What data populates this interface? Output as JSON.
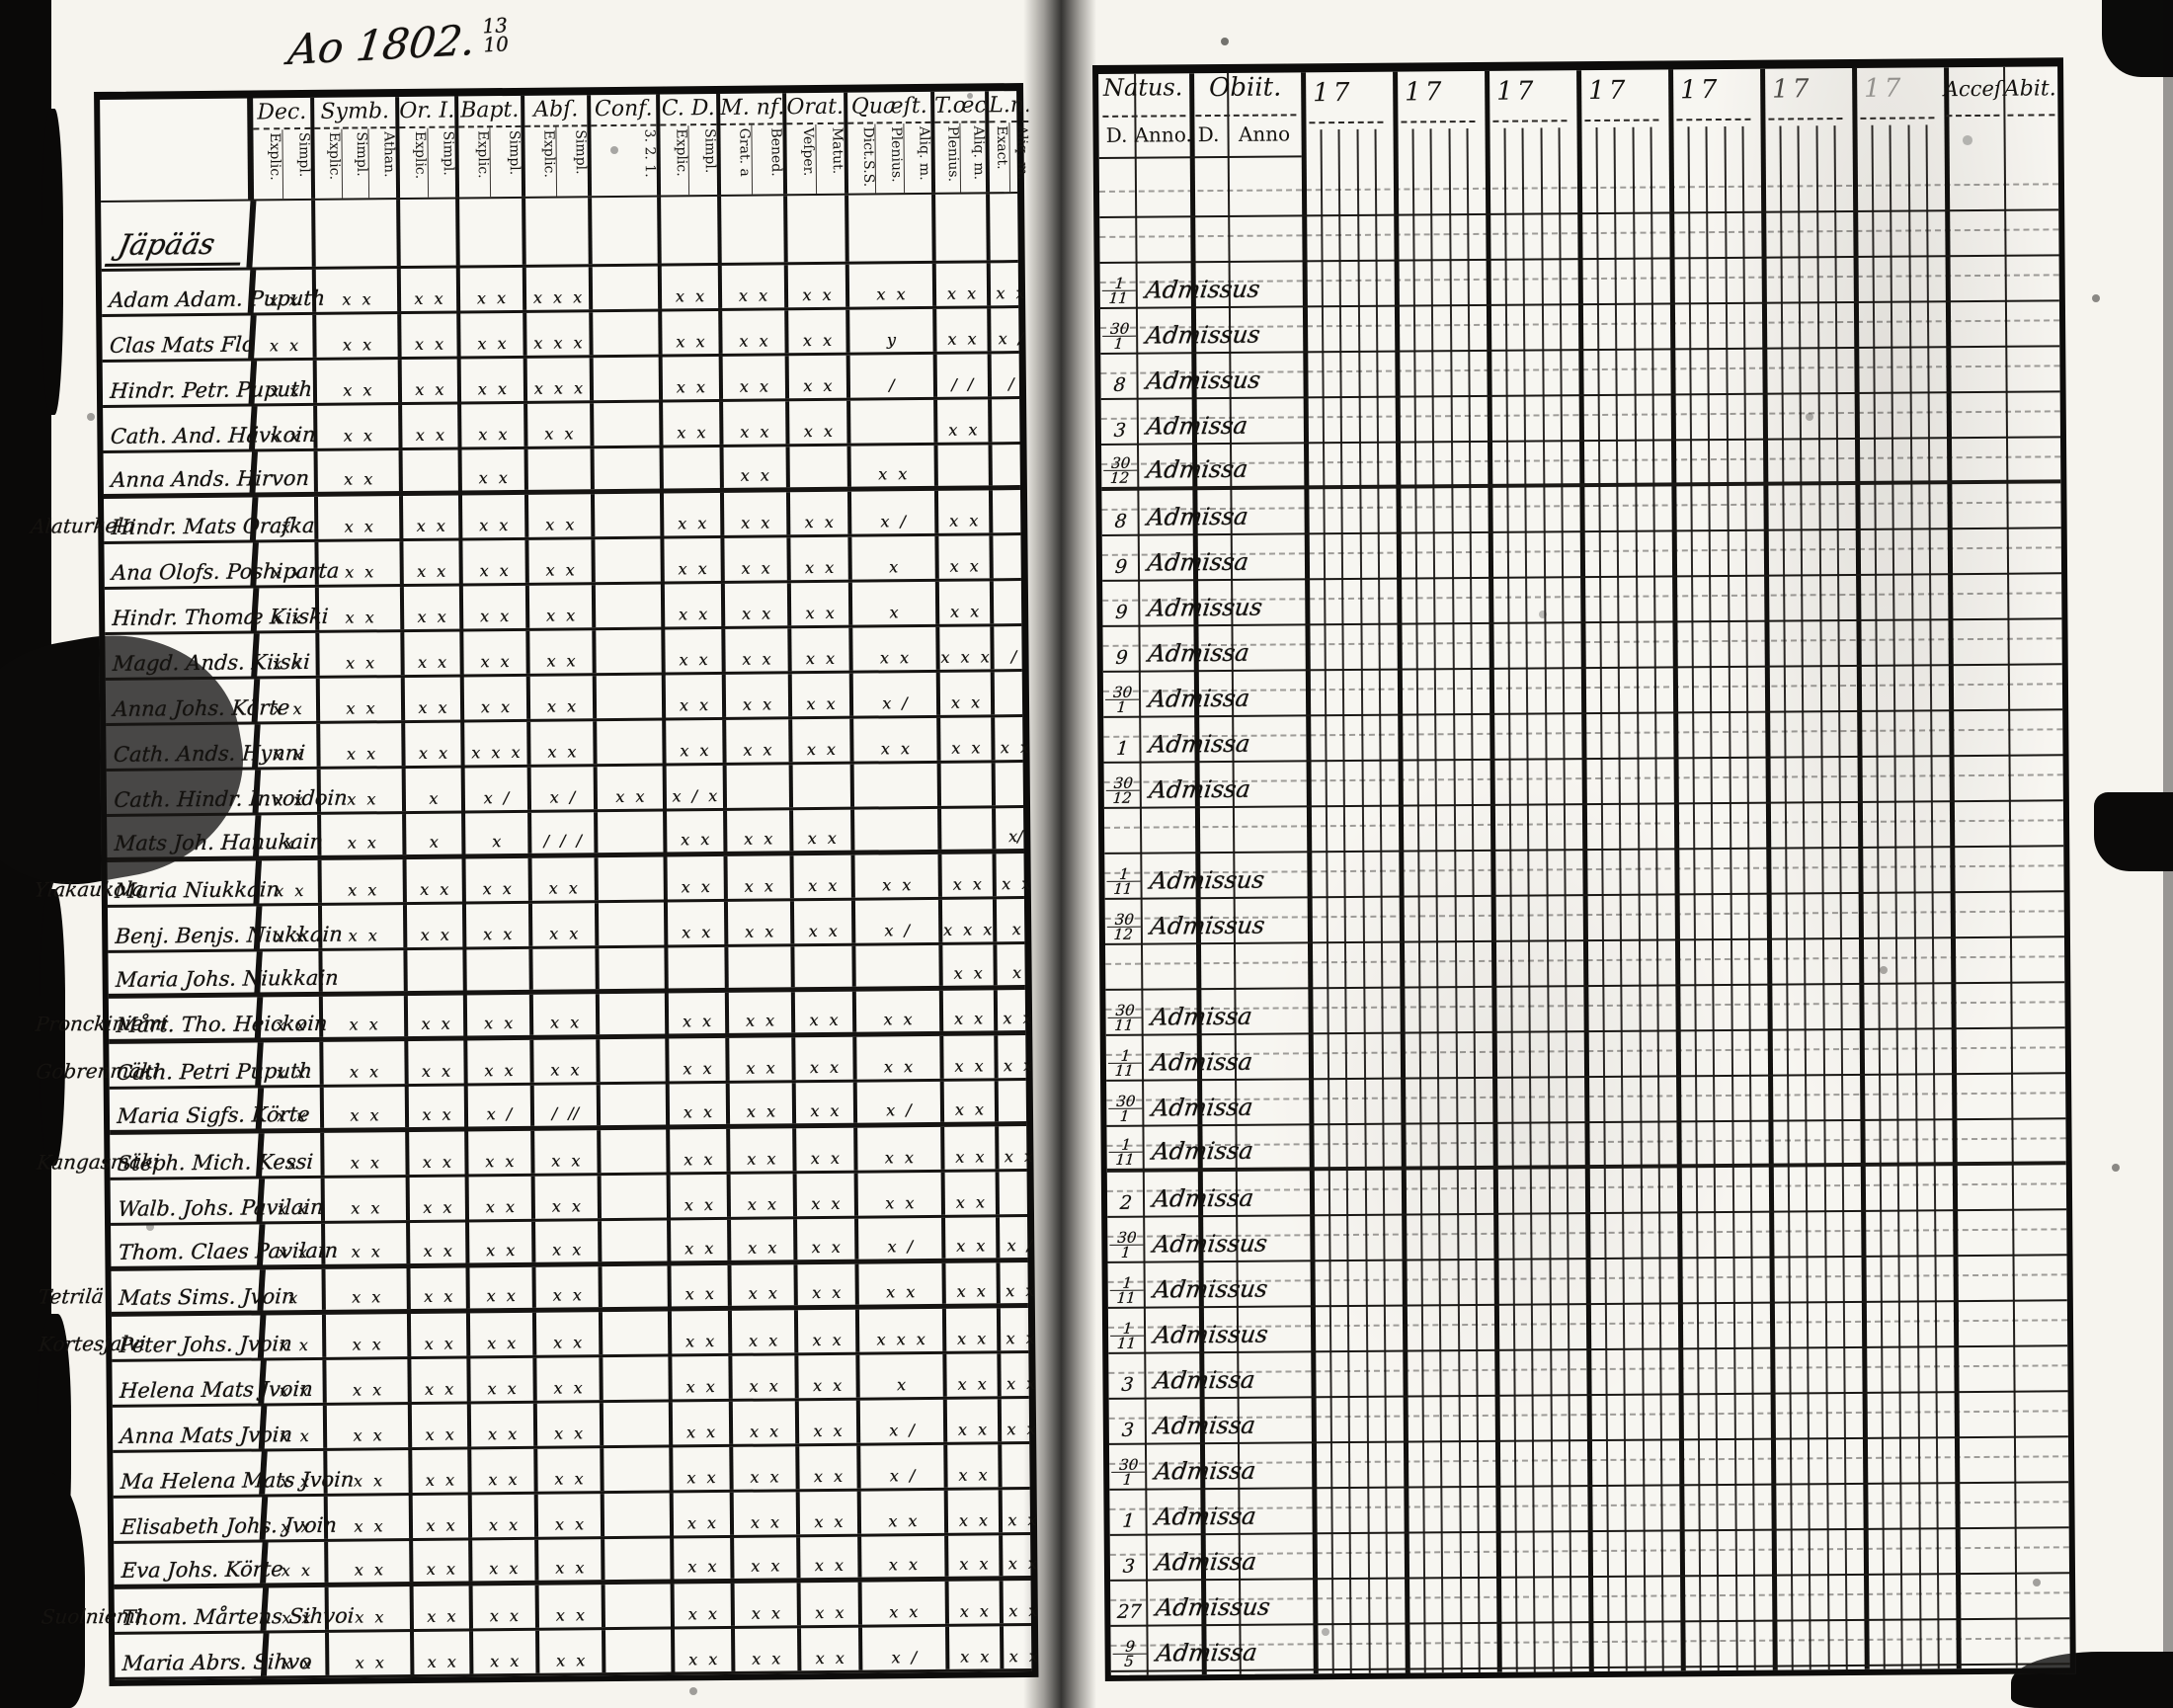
{
  "colors": {
    "ink": "#14120f",
    "paper": "#f6f4ee",
    "edge": "#0a0908"
  },
  "page": {
    "title_script": "Ao 1802.",
    "title_fraction_top": "13",
    "title_fraction_bottom": "10"
  },
  "left_table": {
    "section_header": "Jäpääs",
    "columns": [
      {
        "label": "Dec.",
        "subs": [
          "Explic.",
          "Simpl."
        ]
      },
      {
        "label": "Symb.",
        "subs": [
          "Explic.",
          "Simpl.",
          "Athan."
        ]
      },
      {
        "label": "Or. I.",
        "subs": [
          "Explic.",
          "Simpl."
        ]
      },
      {
        "label": "Bapt.",
        "subs": [
          "Explic.",
          "Simpl."
        ]
      },
      {
        "label": "Abſ.",
        "subs": [
          "Explic.",
          "Simpl."
        ]
      },
      {
        "label": "Conf.",
        "subs": [
          "3. 2. 1."
        ]
      },
      {
        "label": "C. D.",
        "subs": [
          "Explic.",
          "Simpl."
        ]
      },
      {
        "label": "M. nf.",
        "subs": [
          "Grat. a",
          "Bened."
        ]
      },
      {
        "label": "Orat.",
        "subs": [
          "Veſper.",
          "Matut."
        ]
      },
      {
        "label": "Quæſt.",
        "subs": [
          "Dict.S.S.",
          "Plenius.",
          "Aliq. m."
        ]
      },
      {
        "label": "T.œc.",
        "subs": [
          "Plenius.",
          "Aliq. m."
        ]
      },
      {
        "label": "L.n.",
        "subs": [
          "Exact.",
          "Aliq. m."
        ]
      }
    ],
    "rows": [
      {
        "margin": "",
        "name": "Adam Adam. Puputh",
        "cells": [
          "x x",
          "x x",
          "x x",
          "x x",
          "x x x",
          "",
          "x x",
          "x x",
          "x x",
          "x x",
          "x x",
          "x x"
        ]
      },
      {
        "margin": "",
        "name": "Clas Mats Flo",
        "cells": [
          "x x",
          "x x",
          "x x",
          "x x",
          "x x x",
          "",
          "x x",
          "x x",
          "x x",
          "y",
          "x x",
          "x /"
        ]
      },
      {
        "margin": "",
        "name": "Hindr. Petr. Puputh",
        "cells": [
          "x x",
          "x x",
          "x x",
          "x x",
          "x x x",
          "",
          "x x",
          "x x",
          "x x",
          "/",
          "/ /",
          "/"
        ]
      },
      {
        "margin": "",
        "name": "Cath. And. Hävkoin",
        "cells": [
          "x x",
          "x x",
          "x x",
          "x x",
          "x x",
          "",
          "x x",
          "x x",
          "x x",
          "",
          "x x",
          ""
        ]
      },
      {
        "margin": "",
        "name": "Anna Ands. Hirvon",
        "cells": [
          "",
          "x x",
          "",
          "x x",
          "",
          "",
          "",
          "x x",
          "",
          "x x",
          "",
          ""
        ]
      },
      {
        "margin": "Alaturkela",
        "name": "Hindr. Mats Orafka",
        "cells": [
          "x",
          "x x",
          "x x",
          "x x",
          "x x",
          "",
          "x x",
          "x x",
          "x x",
          "x /",
          "x x",
          ""
        ]
      },
      {
        "margin": "",
        "name": "Ana Olofs. Poshiparta",
        "cells": [
          "x x",
          "x x",
          "x x",
          "x x",
          "x x",
          "",
          "x x",
          "x x",
          "x x",
          "x",
          "x x",
          ""
        ]
      },
      {
        "margin": "",
        "name": "Hindr. Thomæ Kiiski",
        "cells": [
          "x x",
          "x x",
          "x x",
          "x x",
          "x x",
          "",
          "x x",
          "x x",
          "x x",
          "x",
          "x x",
          ""
        ]
      },
      {
        "margin": "",
        "name": "Magd. Ands. Kiiski",
        "cells": [
          "x x",
          "x x",
          "x x",
          "x x",
          "x x",
          "",
          "x x",
          "x x",
          "x x",
          "x x",
          "x x x",
          "/"
        ]
      },
      {
        "margin": "",
        "name": "Anna Johs. Körte",
        "cells": [
          "x x",
          "x x",
          "x x",
          "x x",
          "x x",
          "",
          "x x",
          "x x",
          "x x",
          "x /",
          "x x",
          ""
        ]
      },
      {
        "margin": "",
        "name": "Cath. Ands. Hynni",
        "cells": [
          "x x",
          "x x",
          "x x",
          "x x x",
          "x x",
          "",
          "x x",
          "x x",
          "x x",
          "x x",
          "x x",
          "x x"
        ]
      },
      {
        "margin": "",
        "name": "Cath. Hindr. Invoidoin",
        "cells": [
          "x x",
          "x x",
          "x",
          "x /",
          "x /",
          "x x",
          "x / x",
          "",
          "",
          "",
          "",
          ""
        ]
      },
      {
        "margin": "",
        "name": "Mats Joh. Hanukain",
        "cells": [
          "x",
          "x x",
          "x",
          "x",
          "/ / /",
          "",
          "x x",
          "x x",
          "x x",
          "",
          "",
          "x/"
        ]
      },
      {
        "margin": "Yläkaukola",
        "name": "Maria Niukkain",
        "cells": [
          "x x",
          "x x",
          "x x",
          "x x",
          "x x",
          "",
          "x x",
          "x x",
          "x x",
          "x x",
          "x x",
          "x x"
        ]
      },
      {
        "margin": "",
        "name": "Benj. Benjs. Niukkain",
        "cells": [
          "x x",
          "x x",
          "x x",
          "x x",
          "x x",
          "",
          "x x",
          "x x",
          "x x",
          "x /",
          "x x x",
          "x"
        ]
      },
      {
        "margin": "",
        "name": "Maria Johs. Niukkain",
        "cells": [
          "",
          "",
          "",
          "",
          "",
          "",
          "",
          "",
          "",
          "",
          "x x",
          "x"
        ]
      },
      {
        "margin": "Pronckiniemi",
        "name": "Mårt. Tho. Heickoin",
        "cells": [
          "x x",
          "x x",
          "x x",
          "x x",
          "x x",
          "",
          "x x",
          "x x",
          "x x",
          "x x",
          "x x",
          "x x"
        ]
      },
      {
        "margin": "Gobrenmäki",
        "name": "Cath. Petri Puputh",
        "cells": [
          "x x",
          "x x",
          "x x",
          "x x",
          "x x",
          "",
          "x x",
          "x x",
          "x x",
          "x x",
          "x x",
          "x x"
        ]
      },
      {
        "margin": "",
        "name": "Maria Sigfs. Körte",
        "cells": [
          "x x",
          "x x",
          "x x",
          "x /",
          "/ //",
          "",
          "x x",
          "x x",
          "x x",
          "x /",
          "x x",
          ""
        ]
      },
      {
        "margin": "Kangasmäki",
        "name": "Steph. Mich. Kessi",
        "cells": [
          "x",
          "x x",
          "x x",
          "x x",
          "x x",
          "",
          "x x",
          "x x",
          "x x",
          "x x",
          "x x",
          "x x"
        ]
      },
      {
        "margin": "",
        "name": "Walb. Johs. Pavilain",
        "cells": [
          "x x",
          "x x",
          "x x",
          "x x",
          "x x",
          "",
          "x x",
          "x x",
          "x x",
          "x x",
          "x x",
          ""
        ]
      },
      {
        "margin": "",
        "name": "Thom. Claes Pavilain",
        "cells": [
          "x x",
          "x x",
          "x x",
          "x x",
          "x x",
          "",
          "x x",
          "x x",
          "x x",
          "x /",
          "x x",
          "x /"
        ]
      },
      {
        "margin": "Tetrilä",
        "name": "Mats Sims. Jvoin",
        "cells": [
          "x",
          "x x",
          "x x",
          "x x",
          "x x",
          "",
          "x x",
          "x x",
          "x x",
          "x x",
          "x x",
          "x x"
        ]
      },
      {
        "margin": "Kortesjalvi",
        "name": "Peter Johs. Jvoin",
        "cells": [
          "x x",
          "x x",
          "x x",
          "x x",
          "x x",
          "",
          "x x",
          "x x",
          "x x",
          "x x x",
          "x x",
          "x x"
        ]
      },
      {
        "margin": "",
        "name": "Helena Mats Jvoin",
        "cells": [
          "x x",
          "x x",
          "x x",
          "x x",
          "x x",
          "",
          "x x",
          "x x",
          "x x",
          "x",
          "x x",
          "x x"
        ]
      },
      {
        "margin": "",
        "name": "Anna Mats Jvoin",
        "cells": [
          "x x",
          "x x",
          "x x",
          "x x",
          "x x",
          "",
          "x x",
          "x x",
          "x x",
          "x /",
          "x x",
          "x x"
        ]
      },
      {
        "margin": "",
        "name": "Ma Helena Mats Jvoin",
        "cells": [
          "x x",
          "x x",
          "x x",
          "x x",
          "x x",
          "",
          "x x",
          "x x",
          "x x",
          "x /",
          "x x",
          ""
        ]
      },
      {
        "margin": "",
        "name": "Elisabeth Johs. Jvoin",
        "cells": [
          "x x",
          "x x",
          "x x",
          "x x",
          "x x",
          "",
          "x x",
          "x x",
          "x x",
          "x x",
          "x x",
          "x x"
        ]
      },
      {
        "margin": "",
        "name": "Eva Johs. Körte",
        "cells": [
          "x x",
          "x x",
          "x x",
          "x x",
          "x x",
          "",
          "x x",
          "x x",
          "x x",
          "x x",
          "x x",
          "x x"
        ]
      },
      {
        "margin": "Suolniemi",
        "name": "Thom. Mårtens Sihvoi",
        "cells": [
          "x x",
          "x x",
          "x x",
          "x x",
          "x x",
          "",
          "x x",
          "x x",
          "x x",
          "x x",
          "x x",
          "x x"
        ]
      },
      {
        "margin": "",
        "name": "Maria Abrs. Sihvo",
        "cells": [
          "x x",
          "x x",
          "x x",
          "x x",
          "x x",
          "",
          "x x",
          "x x",
          "x x",
          "x /",
          "x x",
          "x x"
        ]
      }
    ]
  },
  "right_table": {
    "natus_label": "Natus.",
    "obiit_label": "Obiit.",
    "natus_d": "D.",
    "natus_anno": "Anno.",
    "obiit_d": "D.",
    "obiit_anno": "Anno",
    "year_groups": [
      "17",
      "17",
      "17",
      "17",
      "17",
      "17",
      "17"
    ],
    "acces_label": "Acceſ",
    "abit_label": "Abit.",
    "rows": [
      {
        "year": "",
        "d": "1/11",
        "note": "Admissus"
      },
      {
        "year": "1803.",
        "d": "30/1",
        "note": "Admissus"
      },
      {
        "year": "",
        "d": "8",
        "note": "Admissus"
      },
      {
        "year": "",
        "d": "3",
        "note": "Admissa"
      },
      {
        "year": "",
        "d": "30/12",
        "note": "Admissa"
      },
      {
        "year": "",
        "d": "8",
        "note": "Admissa"
      },
      {
        "year": "",
        "d": "9",
        "note": "Admissa"
      },
      {
        "year": "",
        "d": "9",
        "note": "Admissus"
      },
      {
        "year": "",
        "d": "9",
        "note": "Admissa"
      },
      {
        "year": "1803.",
        "d": "30/1",
        "note": "Admissa"
      },
      {
        "year": "",
        "d": "1",
        "note": "Admissa"
      },
      {
        "year": "",
        "d": "30/12",
        "note": "Admissa"
      },
      {
        "year": "",
        "d": "",
        "note": ""
      },
      {
        "year": "",
        "d": "1/11",
        "note": "Admissus"
      },
      {
        "year": "",
        "d": "30/12",
        "note": "Admissus"
      },
      {
        "year": "",
        "d": "",
        "note": ""
      },
      {
        "year": "",
        "d": "30/11",
        "note": "Admissa"
      },
      {
        "year": "",
        "d": "1/11",
        "note": "Admissa"
      },
      {
        "year": "1807.",
        "d": "30/1",
        "note": "Admissa"
      },
      {
        "year": "",
        "d": "1/11",
        "note": "Admissa"
      },
      {
        "year": "",
        "d": "2",
        "note": "Admissa"
      },
      {
        "year": "1807.",
        "d": "30/1",
        "note": "Admissus"
      },
      {
        "year": "",
        "d": "1/11",
        "note": "Admissus"
      },
      {
        "year": "",
        "d": "1/11",
        "note": "Admissus"
      },
      {
        "year": "",
        "d": "3",
        "note": "Admissa"
      },
      {
        "year": "",
        "d": "3",
        "note": "Admissa"
      },
      {
        "year": "1803.",
        "d": "30/1",
        "note": "Admissa"
      },
      {
        "year": "",
        "d": "1",
        "note": "Admissa"
      },
      {
        "year": "1807.",
        "d": "3",
        "note": "Admissa"
      },
      {
        "year": "1803.",
        "d": "27",
        "note": "Admissus"
      },
      {
        "year": "",
        "d": "9/5",
        "note": "Admissa"
      }
    ]
  }
}
